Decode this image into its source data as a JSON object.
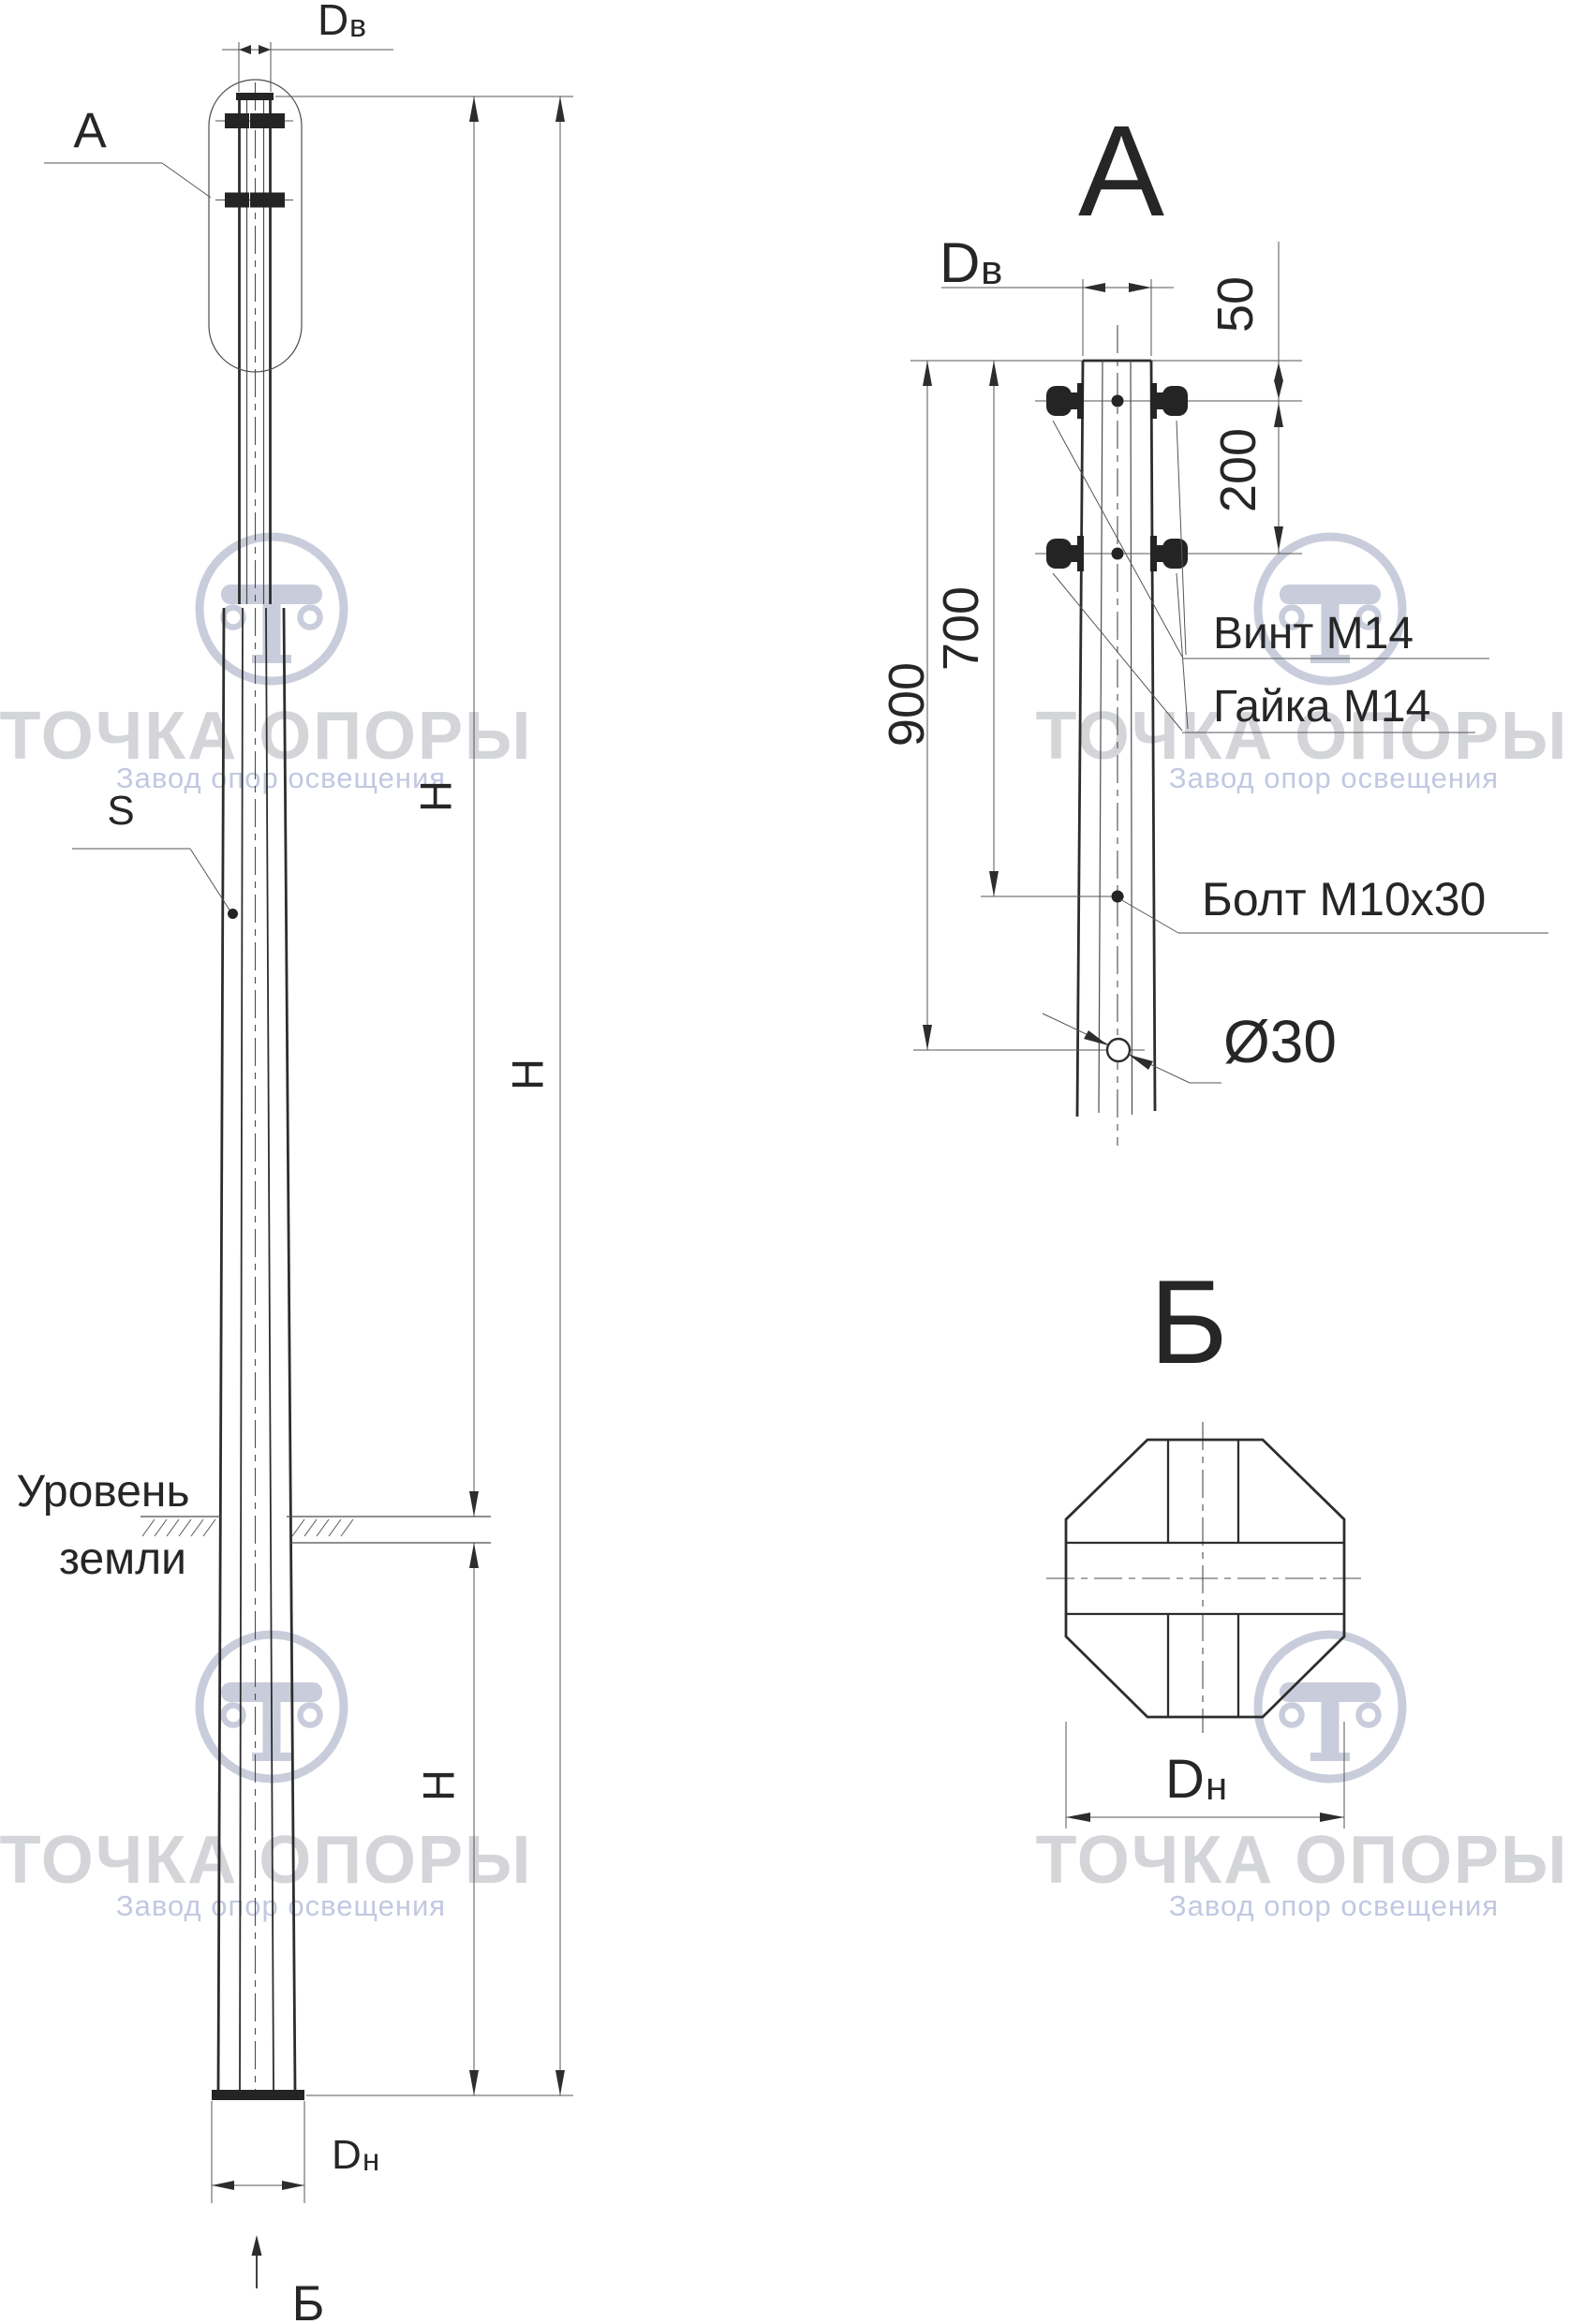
{
  "watermark": {
    "brand": "ТОЧКА ОПОРЫ",
    "tagline": "Завод опор освещения"
  },
  "left_view": {
    "detail_ref_label": "А",
    "section_ref_label": "Б",
    "top_diameter": {
      "base": "D",
      "sub": "в"
    },
    "bottom_diameter": {
      "base": "D",
      "sub": "н"
    },
    "height_label": "Н",
    "wall_thickness_label": "S",
    "ground_level_line1": "Уровень",
    "ground_level_line2": "земли"
  },
  "detail_a": {
    "title": "А",
    "top_diameter": {
      "base": "D",
      "sub": "в"
    },
    "dim_50": "50",
    "dim_200": "200",
    "dim_700": "700",
    "dim_900": "900",
    "screw_label": "Винт М14",
    "nut_label": "Гайка М14",
    "bolt_label": "Болт М10х30",
    "hole_diameter_label": "Ø30"
  },
  "section_b": {
    "title": "Б",
    "bottom_diameter": {
      "base": "D",
      "sub": "н"
    }
  }
}
